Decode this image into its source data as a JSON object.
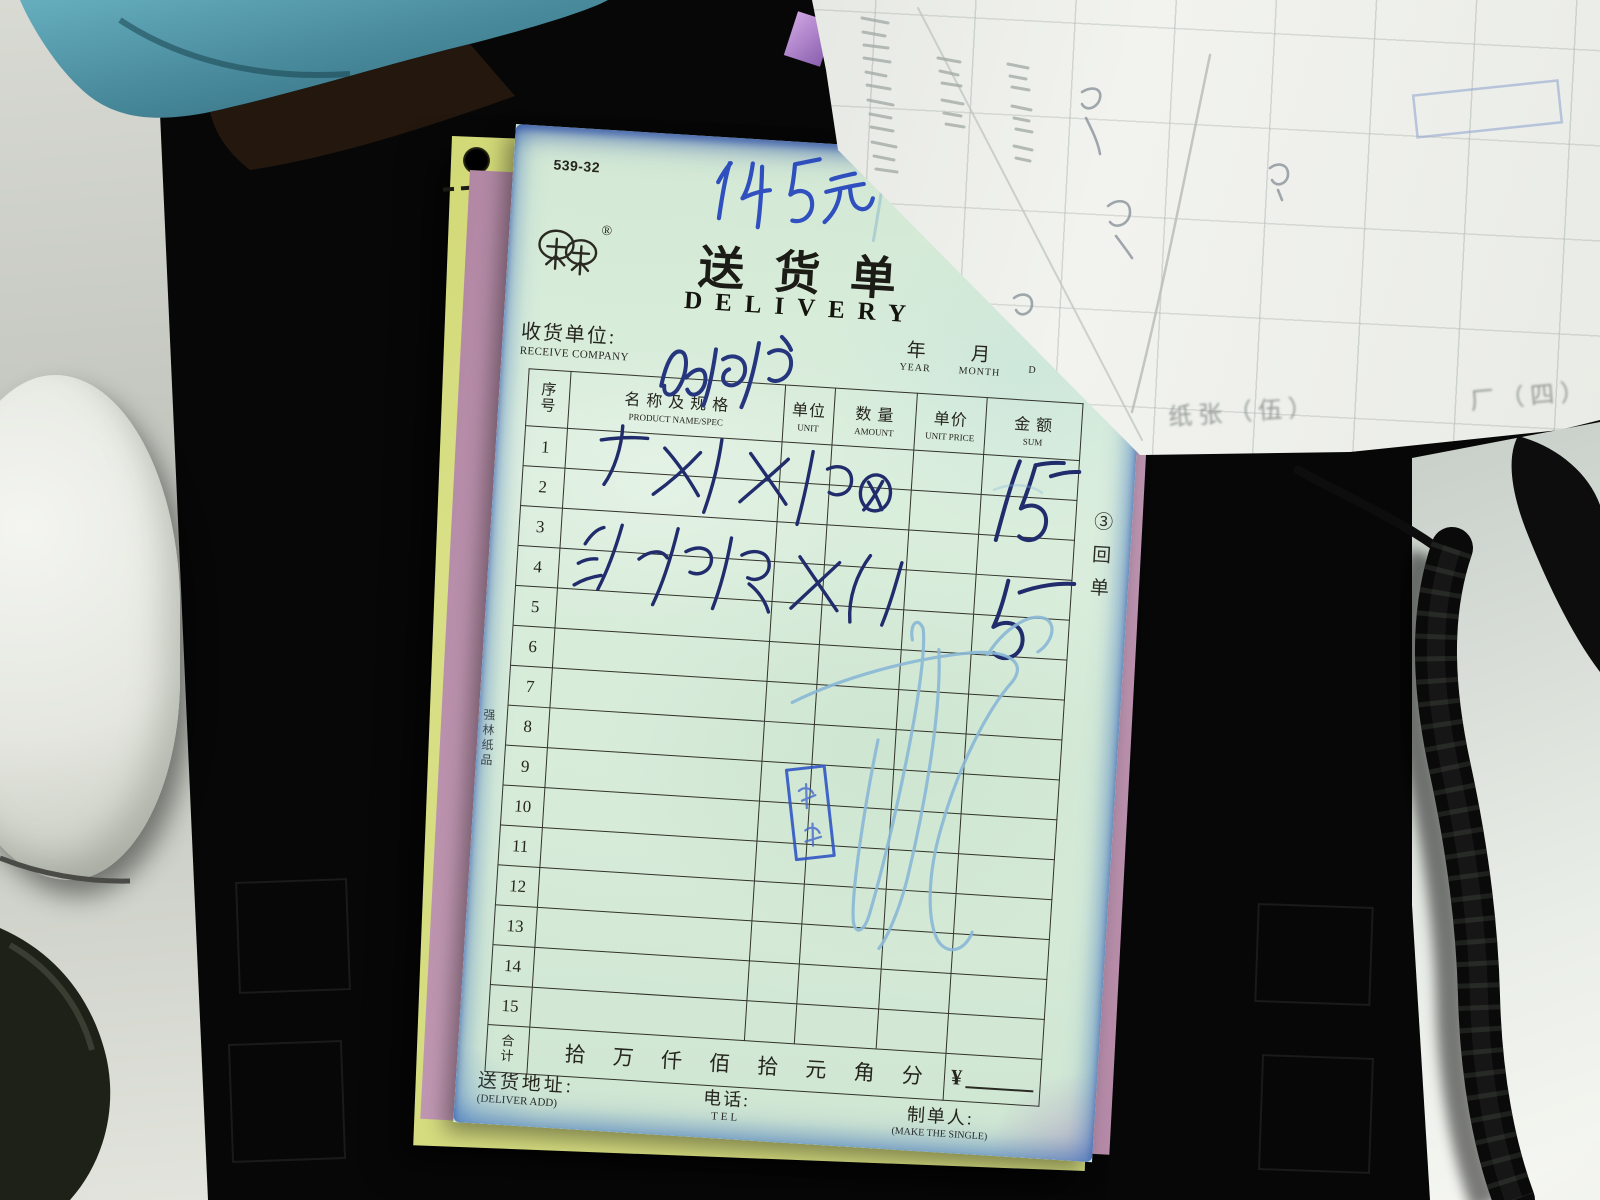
{
  "delivery_form": {
    "form_code": "539-32",
    "handwritten_note_top": "145元",
    "registered_mark": "®",
    "logo": "twin-tree-trademark",
    "title_cn": "送货单",
    "title_en": "DELIVERY",
    "number_label": "№",
    "number_value_handwritten": "33",
    "receiver": {
      "label_cn": "收货单位:",
      "label_en": "RECEIVE COMPANY",
      "value_handwritten": "杨浦"
    },
    "date_header": {
      "year_cn": "年",
      "year_en": "YEAR",
      "month_cn": "月",
      "month_en": "MONTH",
      "day_en_partial": "D"
    },
    "table": {
      "headers": {
        "index_cn": "序号",
        "name_cn": "名 称 及 规 格",
        "name_en": "PRODUCT NAME/SPEC",
        "unit_cn": "单位",
        "unit_en": "UNIT",
        "amount_cn": "数 量",
        "amount_en": "AMOUNT",
        "price_cn": "单价",
        "price_en": "UNIT PRICE",
        "sum_cn": "金 额",
        "sum_en": "SUM"
      },
      "row_numbers": [
        "1",
        "2",
        "3",
        "4",
        "5",
        "6",
        "7",
        "8",
        "9",
        "10",
        "11",
        "12",
        "13",
        "14",
        "15"
      ],
      "handwritten_entries": [
        {
          "product_name": "干报X桶",
          "rows": "1-2",
          "sum": "15"
        },
        {
          "product_name": "沟浮撤X(",
          "rows": "3-4",
          "sum": "5 —"
        }
      ],
      "total_row": {
        "label_cn": "合计",
        "digit_units": "拾 万 仟 佰 拾 元 角 分",
        "currency_symbol": "¥"
      }
    },
    "footer": {
      "address_cn": "送货地址:",
      "address_en": "(DELIVER ADD)",
      "tel_cn": "电话:",
      "tel_en": "TEL",
      "maker_cn": "制单人:",
      "maker_en": "(MAKE THE SINGLE)"
    },
    "left_edge_vertical_text": "强林纸品",
    "right_edge_vertical_text": "③回单",
    "stamp": {
      "color": "#2f55c4",
      "description": "blue vertical rectangular stamp, illegible characters"
    }
  },
  "background_sheet": {
    "ghost_text_left": "纸张（伍）",
    "ghost_text_right": "厂（四）"
  },
  "colors": {
    "form_paper": "#d7ead9",
    "yellow_sheet": "#d6dd7f",
    "pink_sheet": "#c399b3",
    "white_sheet": "#eceeea",
    "ink_blue": "#2847b8",
    "light_scribble_blue": "#8ab8d6",
    "stain_blue": "#4a7dc8",
    "desk_black": "#0a0a0a",
    "surface_gray": "#c9ccc5"
  }
}
